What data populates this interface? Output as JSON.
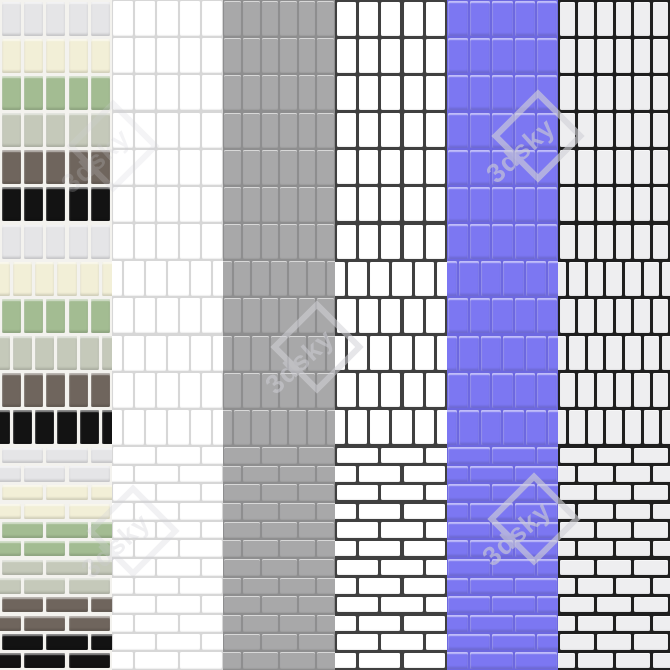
{
  "image": {
    "kind": "tile-material-texture-preview",
    "width": 670,
    "height": 670
  },
  "watermark": {
    "text": "3dsky",
    "color": "#cdcdd4",
    "diamond_stroke": "#d2d2d8",
    "positions": [
      {
        "x": 538,
        "y": 136,
        "opacity": 0.62
      },
      {
        "x": 317,
        "y": 347,
        "opacity": 0.55
      },
      {
        "x": 534,
        "y": 519,
        "opacity": 0.62
      },
      {
        "x": 133,
        "y": 531,
        "opacity": 0.3
      },
      {
        "x": 113,
        "y": 146,
        "opacity": 0.22
      }
    ]
  },
  "columns": [
    {
      "id": "multicolor-mosaic",
      "type": "stripes",
      "stripes": [
        "#e5e5e7",
        "#f2efd7",
        "#a3bc92",
        "#c5c9ba",
        "#6f655d",
        "#131313"
      ],
      "grout": "#f3f2ee",
      "tiles_per_row": 5,
      "grout_px": 3,
      "finish": "gloss",
      "textured": false
    },
    {
      "id": "white-light-grout",
      "type": "solid",
      "tile": "#ffffff",
      "grout": "#d7d7d7",
      "tiles_per_row": 5,
      "grout_px": 2,
      "finish": "matte",
      "textured": false
    },
    {
      "id": "gray",
      "type": "solid",
      "tile": "#a8a8a9",
      "grout": "#8e8e8f",
      "tiles_per_row": 6,
      "grout_px": 2,
      "finish": "matte",
      "textured": false
    },
    {
      "id": "white-dark-grout",
      "type": "solid",
      "tile": "#ffffff",
      "grout": "#404040",
      "tiles_per_row": 5,
      "grout_px": 3,
      "finish": "matte",
      "textured": false
    },
    {
      "id": "blue-violet",
      "type": "solid",
      "tile": "#7c77f2",
      "grout": "#6d68e0",
      "tiles_per_row": 5,
      "grout_px": 2,
      "finish": "gloss",
      "textured": false
    },
    {
      "id": "offwhite-black-grout",
      "type": "solid",
      "tile": "#eeeef0",
      "grout": "#1f1f1f",
      "tiles_per_row": 6,
      "grout_px": 3,
      "finish": "matte",
      "textured": true
    }
  ],
  "bands": [
    {
      "id": "stacked-grid",
      "layout": "grid",
      "y": 0,
      "height": 223,
      "rows": 6
    },
    {
      "id": "vertical-offset",
      "layout": "offset",
      "y": 223,
      "height": 223,
      "rows": 6
    },
    {
      "id": "brick-bond",
      "layout": "brick",
      "y": 446,
      "height": 224,
      "rows": 12
    }
  ]
}
